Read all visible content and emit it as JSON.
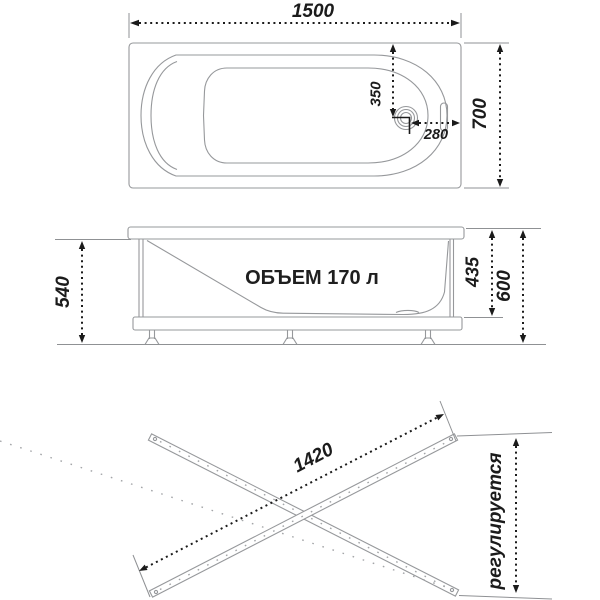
{
  "views": {
    "top": {
      "length": "1500",
      "width": "700",
      "drain_offset_vertical": "350",
      "drain_offset_horizontal": "280"
    },
    "side": {
      "volume": "ОБЪЕМ 170 л",
      "height_left": "540",
      "height_rim_to_frame": "435",
      "height_total": "600"
    },
    "base": {
      "rail_length": "1420",
      "adjustable": "регулируется"
    }
  },
  "colors": {
    "outline": "#96989b",
    "dimension": "#1b1b1b",
    "background": "#ffffff"
  }
}
